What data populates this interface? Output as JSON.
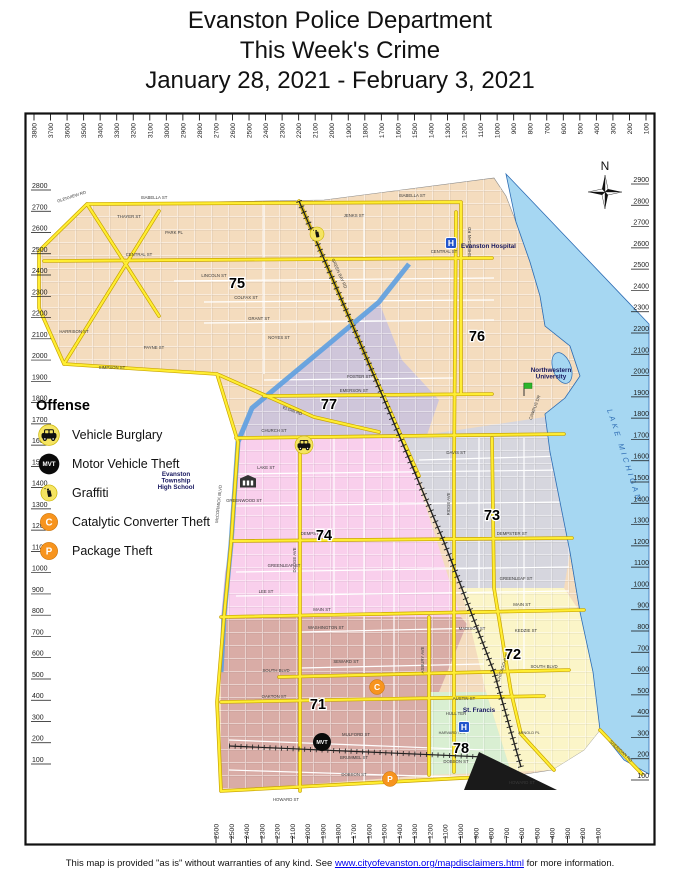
{
  "title": {
    "line1": "Evanston Police Department",
    "line2": "This Week's Crime",
    "line3": "January 28, 2021 - February 3, 2021"
  },
  "legend": {
    "heading": "Offense",
    "items": [
      {
        "id": "vehicle-burglary",
        "label": "Vehicle Burglary",
        "type": "vehicle-burglary",
        "badge": ""
      },
      {
        "id": "motor-vehicle-theft",
        "label": "Motor Vehicle Theft",
        "type": "motor-vehicle-theft",
        "badge": "MVT"
      },
      {
        "id": "graffiti",
        "label": "Graffiti",
        "type": "graffiti",
        "badge": ""
      },
      {
        "id": "catalytic-converter-theft",
        "label": "Catalytic Converter Theft",
        "type": "catalytic-converter-theft",
        "badge": "C"
      },
      {
        "id": "package-theft",
        "label": "Package Theft",
        "type": "package-theft",
        "badge": "P"
      }
    ]
  },
  "compass_label": "N",
  "colors": {
    "beat75_76_tan": "#F4DCBE",
    "beat77_purple": "#CFC6DA",
    "beat74_pink": "#F9CFEC",
    "beat73_gray": "#D6D6DE",
    "beat72_yellow": "#FBF5C8",
    "beat71_mauve": "#D9ACA6",
    "beat78_green": "#D9EFD2",
    "lake_blue": "#A6D7F2",
    "canal_blue": "#5D9FE0",
    "road_yellow": "#FFEE33",
    "marker_yellow": "#F5E462",
    "marker_orange": "#F7941E",
    "marker_black": "#0A0A0A",
    "hospital_blue": "#2255CC",
    "label_navy": "#16165E",
    "lake_text_blue": "#2E6DB4"
  },
  "axes": {
    "top": {
      "values": [
        3800,
        3700,
        3600,
        3500,
        3400,
        3300,
        3200,
        3100,
        3000,
        2900,
        2800,
        2700,
        2600,
        2500,
        2400,
        2300,
        2200,
        2100,
        2000,
        1900,
        1800,
        1700,
        1600,
        1500,
        1400,
        1300,
        1200,
        1100,
        1000,
        900,
        800,
        700,
        600,
        500,
        400,
        300,
        200,
        100
      ]
    },
    "left": {
      "values": [
        2800,
        2700,
        2600,
        2500,
        2400,
        2300,
        2200,
        2100,
        2000,
        1900,
        1800,
        1700,
        1600,
        1500,
        1400,
        1300,
        1200,
        1100,
        1000,
        900,
        800,
        700,
        600,
        500,
        400,
        300,
        200,
        100
      ]
    },
    "right": {
      "values": [
        2900,
        2800,
        2700,
        2600,
        2500,
        2400,
        2300,
        2200,
        2100,
        2000,
        1900,
        1800,
        1700,
        1600,
        1500,
        1400,
        1300,
        1200,
        1100,
        1000,
        900,
        800,
        700,
        600,
        500,
        400,
        300,
        200,
        100
      ]
    },
    "bottom": {
      "values": [
        2600,
        2500,
        2400,
        2300,
        2200,
        2100,
        2000,
        1900,
        1800,
        1700,
        1600,
        1500,
        1400,
        1300,
        1200,
        1100,
        1000,
        900,
        800,
        700,
        600,
        500,
        400,
        300,
        200,
        100
      ]
    }
  },
  "map": {
    "lake_label": "LAKE MICHIGAN",
    "beats": [
      {
        "n": "75",
        "x": 213,
        "y": 176
      },
      {
        "n": "76",
        "x": 453,
        "y": 229
      },
      {
        "n": "77",
        "x": 305,
        "y": 297
      },
      {
        "n": "74",
        "x": 300,
        "y": 428
      },
      {
        "n": "73",
        "x": 468,
        "y": 408
      },
      {
        "n": "72",
        "x": 489,
        "y": 547
      },
      {
        "n": "71",
        "x": 294,
        "y": 597
      },
      {
        "n": "78",
        "x": 437,
        "y": 641
      }
    ],
    "landmarks": [
      {
        "id": "evanston-hospital",
        "icon": "hospital",
        "badge": "H",
        "icon_x": 427,
        "icon_y": 131,
        "lines": [
          "Evanston Hospital"
        ],
        "label_x": 437,
        "label_y": 136,
        "anchor": "start"
      },
      {
        "id": "northwestern-university",
        "icon": "flag",
        "badge": "",
        "icon_x": 500,
        "icon_y": 280,
        "lines": [
          "Northwestern",
          "University"
        ],
        "label_x": 527,
        "label_y": 260,
        "anchor": "middle"
      },
      {
        "id": "evanston-township-high-school",
        "icon": "school",
        "badge": "",
        "icon_x": 224,
        "icon_y": 371,
        "lines": [
          "Evanston",
          "Township",
          "High School"
        ],
        "label_x": 152,
        "label_y": 364,
        "anchor": "middle"
      },
      {
        "id": "st-francis",
        "icon": "hospital",
        "badge": "H",
        "icon_x": 440,
        "icon_y": 615,
        "lines": [
          "St. Francis"
        ],
        "label_x": 455,
        "label_y": 600,
        "anchor": "middle"
      }
    ],
    "markers": [
      {
        "type": "graffiti",
        "x": 293,
        "y": 122,
        "badge": ""
      },
      {
        "type": "vehicle-burglary",
        "x": 280,
        "y": 333,
        "badge": ""
      },
      {
        "type": "catalytic-converter-theft",
        "x": 353,
        "y": 575,
        "badge": "C"
      },
      {
        "type": "motor-vehicle-theft",
        "x": 298,
        "y": 630,
        "badge": "MVT"
      },
      {
        "type": "package-theft",
        "x": 366,
        "y": 667,
        "badge": "P"
      }
    ],
    "street_labels": [
      {
        "t": "GLENVIEW RD",
        "x": 48,
        "y": 86,
        "r": -18
      },
      {
        "t": "ISABELLA ST",
        "x": 130,
        "y": 87
      },
      {
        "t": "ISABELLA ST",
        "x": 388,
        "y": 85
      },
      {
        "t": "THAYER ST",
        "x": 105,
        "y": 106
      },
      {
        "t": "PARK PL",
        "x": 150,
        "y": 122
      },
      {
        "t": "JENKS ST",
        "x": 330,
        "y": 105
      },
      {
        "t": "CENTRAL ST",
        "x": 115,
        "y": 144
      },
      {
        "t": "CENTRAL ST",
        "x": 420,
        "y": 141
      },
      {
        "t": "LINCOLN ST",
        "x": 190,
        "y": 165
      },
      {
        "t": "COLFAX ST",
        "x": 222,
        "y": 187
      },
      {
        "t": "GRANT ST",
        "x": 235,
        "y": 208
      },
      {
        "t": "HARRISON ST",
        "x": 50,
        "y": 221
      },
      {
        "t": "NOYES ST",
        "x": 255,
        "y": 227
      },
      {
        "t": "PAYNE ST",
        "x": 130,
        "y": 237
      },
      {
        "t": "SIMPSON ST",
        "x": 88,
        "y": 257
      },
      {
        "t": "FOSTER ST",
        "x": 335,
        "y": 266
      },
      {
        "t": "EMERSON ST",
        "x": 330,
        "y": 280
      },
      {
        "t": "CHURCH ST",
        "x": 250,
        "y": 320
      },
      {
        "t": "DAVIS ST",
        "x": 432,
        "y": 342
      },
      {
        "t": "LAKE ST",
        "x": 242,
        "y": 357
      },
      {
        "t": "GREENWOOD ST",
        "x": 220,
        "y": 390
      },
      {
        "t": "DEMPSTER ST",
        "x": 292,
        "y": 423
      },
      {
        "t": "DEMPSTER ST",
        "x": 488,
        "y": 423
      },
      {
        "t": "GREENLEAF ST",
        "x": 260,
        "y": 455
      },
      {
        "t": "GREENLEAF ST",
        "x": 492,
        "y": 468
      },
      {
        "t": "LEE ST",
        "x": 242,
        "y": 481
      },
      {
        "t": "MAIN ST",
        "x": 298,
        "y": 499
      },
      {
        "t": "MAIN ST",
        "x": 498,
        "y": 494
      },
      {
        "t": "WASHINGTON ST",
        "x": 302,
        "y": 517
      },
      {
        "t": "MADISON ST",
        "x": 448,
        "y": 518
      },
      {
        "t": "KEDZIE ST",
        "x": 502,
        "y": 520
      },
      {
        "t": "SEWARD ST",
        "x": 322,
        "y": 551
      },
      {
        "t": "SOUTH BLVD",
        "x": 252,
        "y": 560
      },
      {
        "t": "SOUTH BLVD",
        "x": 520,
        "y": 556
      },
      {
        "t": "OAKTON ST",
        "x": 250,
        "y": 586
      },
      {
        "t": "AUSTIN ST",
        "x": 440,
        "y": 588
      },
      {
        "t": "HULL TER",
        "x": 432,
        "y": 603
      },
      {
        "t": "HARVARD TER",
        "x": 428,
        "y": 622,
        "s": 3.8
      },
      {
        "t": "MULFORD ST",
        "x": 332,
        "y": 624
      },
      {
        "t": "BRUMMEL ST",
        "x": 330,
        "y": 647
      },
      {
        "t": "DOBSON ST",
        "x": 330,
        "y": 664
      },
      {
        "t": "DOBSON ST",
        "x": 432,
        "y": 651
      },
      {
        "t": "HOWARD ST",
        "x": 262,
        "y": 689
      },
      {
        "t": "HOWARD ST",
        "x": 498,
        "y": 672
      },
      {
        "t": "ARNOLD PL",
        "x": 505,
        "y": 622,
        "s": 3.8
      },
      {
        "t": "SHERIDAN RD",
        "x": 447,
        "y": 130,
        "r": -90
      },
      {
        "t": "SHERIDAN RD",
        "x": 596,
        "y": 640,
        "r": 43
      },
      {
        "t": "GREEN BAY RD",
        "x": 314,
        "y": 162,
        "r": 66
      },
      {
        "t": "McCORMICK BLVD",
        "x": 196,
        "y": 392,
        "r": -84
      },
      {
        "t": "RIDGE AVE",
        "x": 426,
        "y": 392,
        "r": -90
      },
      {
        "t": "ASBURY AVE",
        "x": 400,
        "y": 548,
        "r": -90
      },
      {
        "t": "CHICAGO AVE",
        "x": 480,
        "y": 556,
        "r": -72
      },
      {
        "t": "DODGE AVE",
        "x": 272,
        "y": 448,
        "r": -90
      },
      {
        "t": "CAMPUS DR",
        "x": 512,
        "y": 296,
        "r": -70
      },
      {
        "t": "ELGIN RD",
        "x": 268,
        "y": 300,
        "r": 20
      }
    ]
  },
  "footer": {
    "text_before": "This map is provided \"as is\" without warranties of any kind.  See ",
    "link_text": "www.cityofevanston.org/mapdisclaimers.html",
    "text_after": " for more information."
  }
}
